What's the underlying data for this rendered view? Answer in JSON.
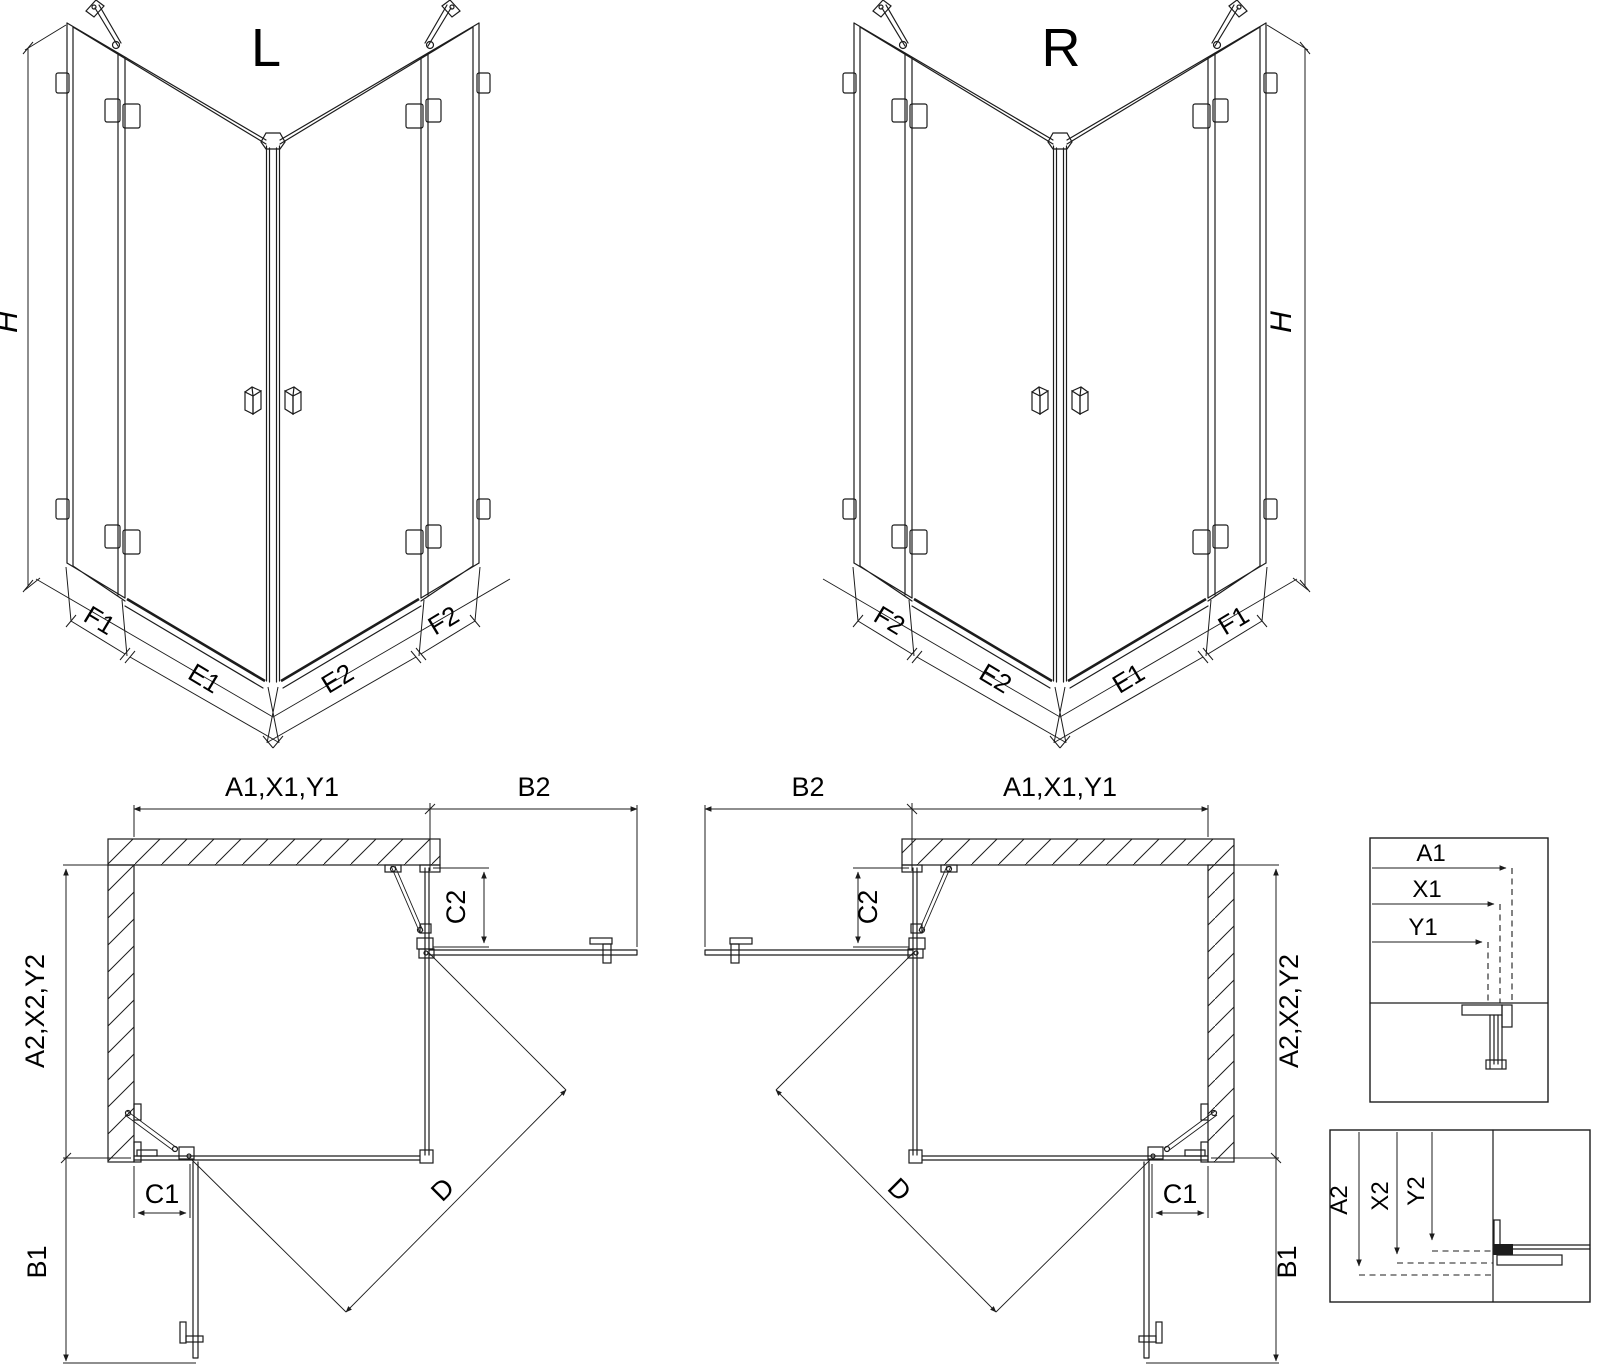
{
  "drawing": {
    "view_l": {
      "title": "L",
      "dim_height": "H",
      "dim_fixed_left": "F1",
      "dim_door_left": "E1",
      "dim_door_right": "E2",
      "dim_fixed_right": "F2"
    },
    "view_r": {
      "title": "R",
      "dim_height": "H",
      "dim_fixed_left": "F2",
      "dim_door_left": "E2",
      "dim_door_right": "E1",
      "dim_fixed_right": "F1"
    },
    "plan_l": {
      "dim_top": "A1,X1,Y1",
      "dim_top_outer": "B2",
      "dim_side": "A2,X2,Y2",
      "dim_fixed_upper": "C2",
      "dim_fixed_lower": "C1",
      "dim_door_lower": "B1",
      "dim_diagonal": "D"
    },
    "plan_r": {
      "dim_top": "A1,X1,Y1",
      "dim_top_outer": "B2",
      "dim_side": "A2,X2,Y2",
      "dim_fixed_upper": "C2",
      "dim_fixed_lower": "C1",
      "dim_door_lower": "B1",
      "dim_diagonal": "D"
    },
    "detail_widths": {
      "row1": "A1",
      "row2": "X1",
      "row3": "Y1"
    },
    "detail_heights": {
      "row1": "A2",
      "row2": "X2",
      "row3": "Y2"
    }
  },
  "colors": {
    "line": "#1c1c1c",
    "background": "#ffffff"
  }
}
